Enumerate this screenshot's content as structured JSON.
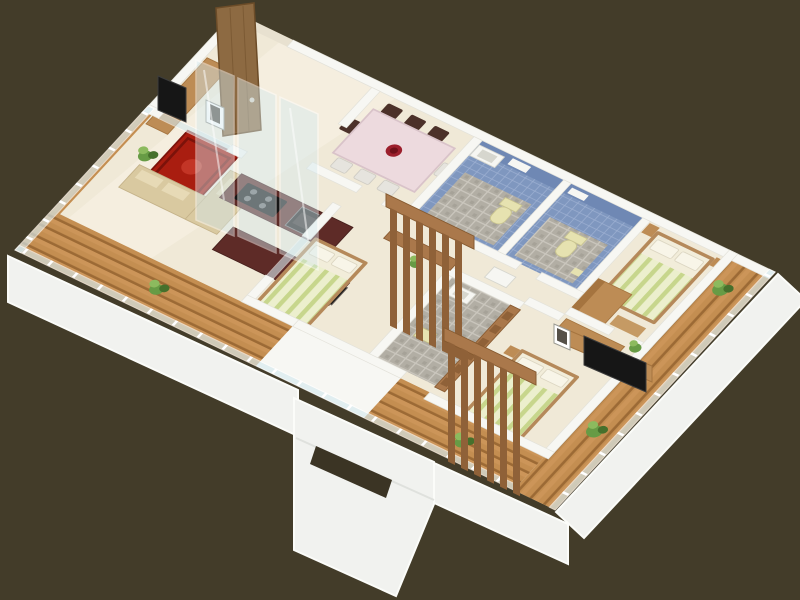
{
  "scene": {
    "type": "isometric-3d-floor-plan-render",
    "view": "rotated-cutaway-apartment",
    "rooms": [
      "living-room",
      "dining-room",
      "kitchen",
      "bathroom-1",
      "bathroom-2",
      "bathroom-3",
      "master-bedroom",
      "middle-bedroom",
      "front-bedroom",
      "hallway",
      "balcony-west",
      "balcony-front",
      "balcony-east"
    ],
    "furniture": [
      "entrance-door",
      "tv-console",
      "wall-tv",
      "red-rug",
      "corner-sofa",
      "dining-table",
      "dining-chairs",
      "center-bowl",
      "kitchen-counter",
      "cooktop",
      "built-in-oven",
      "kitchen-island",
      "toilet",
      "wash-basin",
      "wall-shelf",
      "double-bed",
      "pillows",
      "striped-blanket",
      "wardrobe",
      "bedside-table",
      "foot-bench",
      "wood-slat-screen",
      "glass-railing",
      "glass-sliding-doors",
      "potted-plants",
      "bath-stool"
    ]
  },
  "palette": {
    "bg": "#433c29",
    "wall": "#f7f7f3",
    "wall-shade": "#e3e2da",
    "slab": "#e8e1d0",
    "floor": "#f0e9d7",
    "floor-light": "#f9f4e7",
    "wood": "#c48e51",
    "wood-light": "#d8a468",
    "wood-gap": "#9c6a35",
    "glass": "#d6eaef",
    "glass-frame": "#ffffff",
    "tile-blue": "#7f97bf",
    "tile-blue-light": "#9db0d2",
    "tile-blue-deep": "#6f88b4",
    "mosaic": "#b2aea4",
    "mosaic-grout": "#cac6bd",
    "counter": "#5e2b27",
    "counter-dark": "#451f1c",
    "rug": "#a91d10",
    "rug-dark": "#7c120a",
    "rug-mid": "#c8392a",
    "sofa": "#d9c9a0",
    "sofa-light": "#e7dab6",
    "table-top": "#eddade",
    "table-edge": "#d9c3c9",
    "chair-dark": "#4c3129",
    "chair-light": "#e6e4de",
    "bed-frame": "#b5895a",
    "mattress": "#f2edda",
    "pillow": "#f8f5e8",
    "blanket-a": "#c7d68c",
    "blanket-b": "#ecefcd",
    "box-wood": "#bd8c55",
    "box-wood-dark": "#a5743f",
    "slat": "#8f6138",
    "slat-rail": "#aa784b",
    "door": "#8d6a42",
    "door-dark": "#6c4c28",
    "tv": "#161616",
    "tv-edge": "#3c3c3c",
    "fixture": "#f6f6f2",
    "fixture-edge": "#d6d6ce",
    "fixture-yellow": "#e6e2b0",
    "plant": "#679b45",
    "plant-dark": "#46702c",
    "plant-light": "#8cba5e",
    "band": "#f1f2ef",
    "band-edge": "#fbfcf9",
    "slot": "#3b3424"
  }
}
